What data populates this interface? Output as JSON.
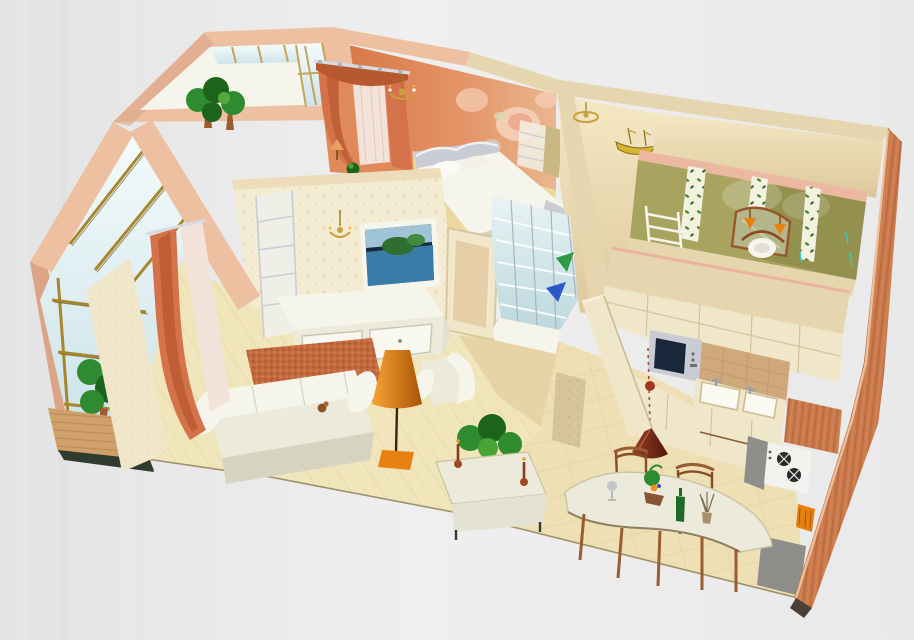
{
  "meta": {
    "type": "3d-floorplan-render",
    "description": "Isometric cutaway 3D rendering of a furnished one-bedroom apartment viewed from above on a gray background",
    "width": 914,
    "height": 640
  },
  "palette": {
    "bgLeft": "#e4e4e4",
    "bgMid": "#efefef",
    "peach": "#eec0a2",
    "peachDark": "#dca487",
    "pinkTop": "#edb8a2",
    "cream": "#f0e7cb",
    "creamDark": "#e6d6b0",
    "wallpaper": "#f3ecd2",
    "floor": "#f1e5bc",
    "kitchenFloor": "#eee0b4",
    "hallFloor": "#e6d3a6",
    "olive": "#a8a35f",
    "oliveDark": "#83813f",
    "extWood": "#ca7a4c",
    "white": "#f6f5ec",
    "furniture": "#eceadb",
    "furnitureShade": "#d6d4bf",
    "rug": "#c2693f",
    "lampOrange": "#e6800f",
    "plantGreen": "#2f8b2f",
    "plantDark": "#1c641c",
    "wood": "#9a5c30",
    "gray": "#8e8e8a",
    "silver": "#c9ccd4",
    "gold": "#c8a03c",
    "sheer": "#f2e2da",
    "curtain": "#d4724a",
    "curtainDark": "#b85830",
    "baseDark": "#2f3b2f",
    "tvScreen": "#18283a",
    "goldFrame": "#a8862e",
    "bedroomWall": "#d67c48"
  },
  "scene": {
    "view": "isometric cutaway from above, rotated clockwise",
    "rooms": [
      {
        "name": "winter-garden",
        "position": "top-left",
        "features": [
          "glazed-windows",
          "potted-palms",
          "peach-wall-tops"
        ]
      },
      {
        "name": "loggia",
        "position": "left",
        "features": [
          "gold-framed-glazing",
          "wood-parapet",
          "plants",
          "dark-base"
        ]
      },
      {
        "name": "bedroom",
        "position": "top-center",
        "features": [
          "floral-mural-wall",
          "curtained-window",
          "double-bed",
          "chandelier",
          "bedside-lamp"
        ]
      },
      {
        "name": "living-room",
        "position": "center-left",
        "features": [
          "wall-tv",
          "tv-stand",
          "shelving-unit",
          "wall-sconce",
          "sofa",
          "armchair",
          "orange-rug",
          "floor-lamp",
          "coffee-table",
          "houseplant",
          "door"
        ]
      },
      {
        "name": "hallway",
        "position": "center",
        "features": [
          "glass-block-display",
          "ship-model",
          "ceiling-light",
          "low-wall"
        ]
      },
      {
        "name": "bathroom",
        "position": "top-right",
        "features": [
          "olive-walls",
          "floral-panels",
          "mirror",
          "sconces",
          "towel-ladder",
          "chair"
        ]
      },
      {
        "name": "kitchen",
        "position": "right",
        "features": [
          "upper-cabinets",
          "microwave",
          "sink",
          "backsplash",
          "gas-stove",
          "wood-cabinet",
          "pendant-lamp"
        ]
      },
      {
        "name": "dining-area",
        "position": "bottom-center",
        "features": [
          "curved-table",
          "two-chairs",
          "green-bottle",
          "table-plant",
          "vase"
        ]
      }
    ],
    "exterior": {
      "cut_wall": "orange wood grain, right edge",
      "background": "plain gray gradient"
    }
  }
}
